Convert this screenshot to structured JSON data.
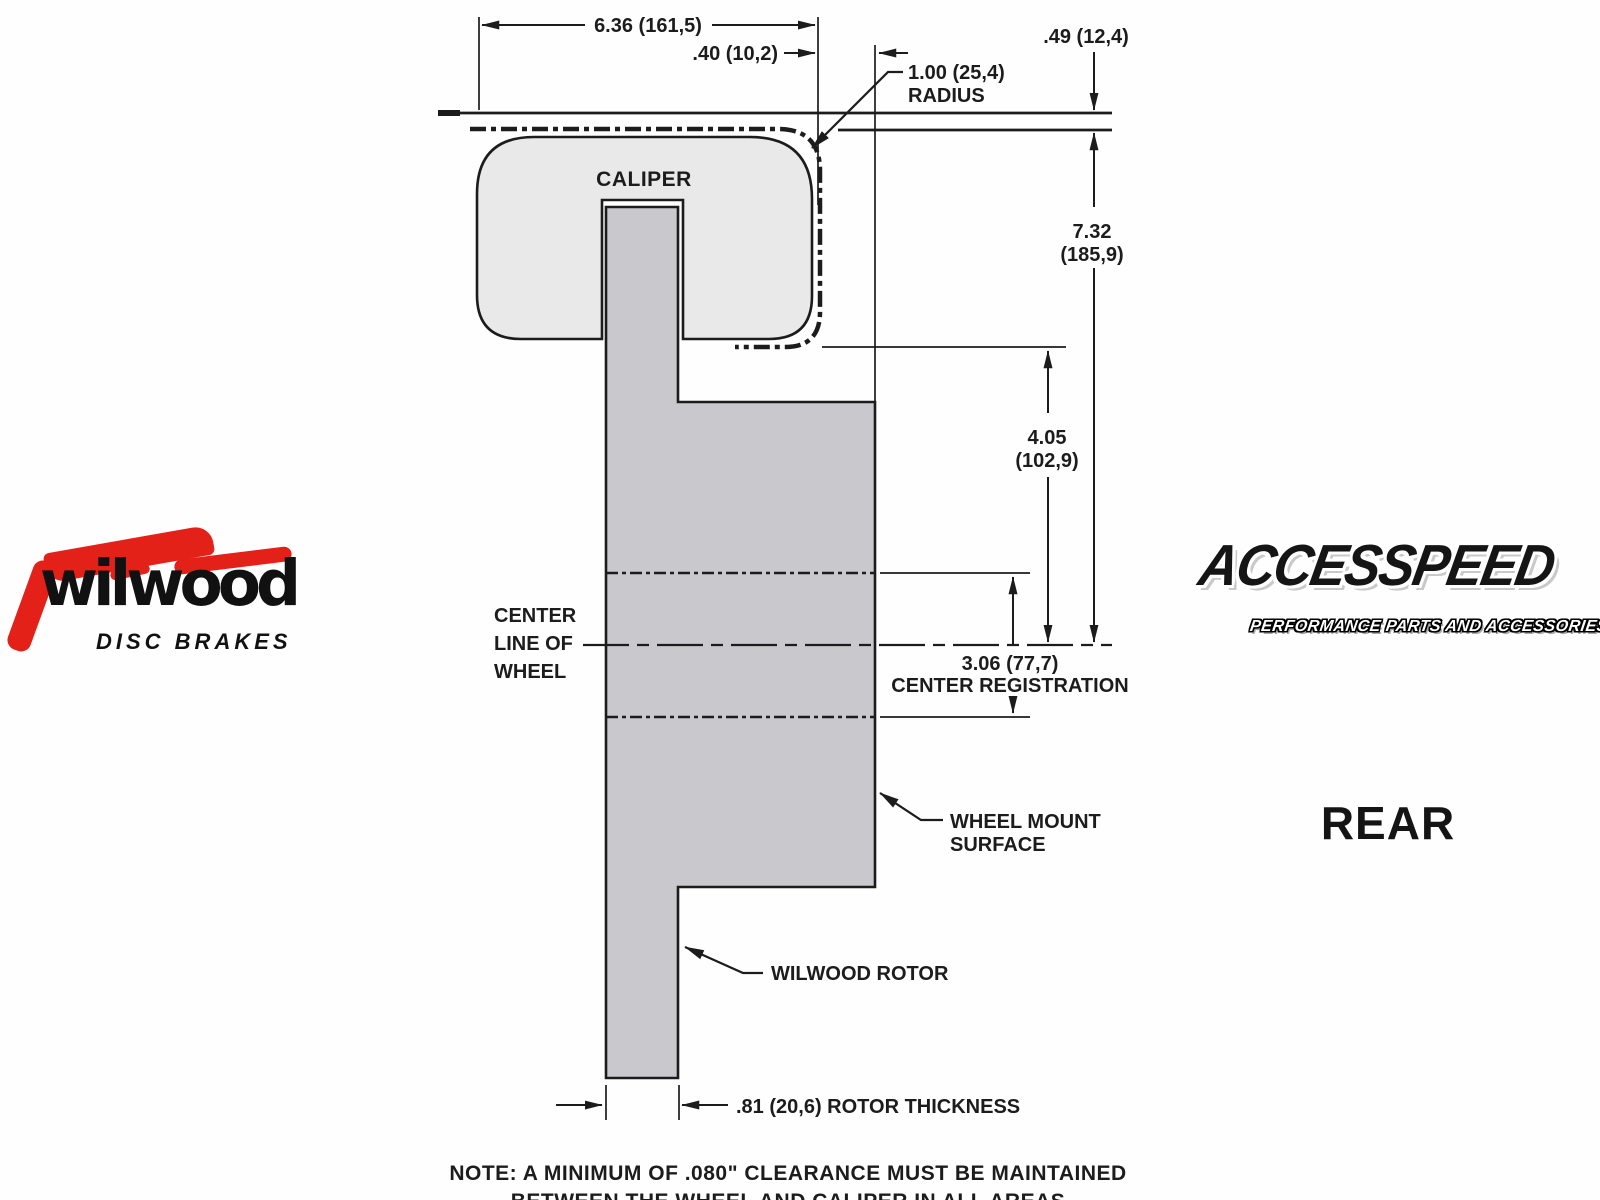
{
  "drawing": {
    "caliper_label": "CALIPER",
    "dim_caliper_width": "6.36 (161,5)",
    "dim_caliper_offset": ".40 (10,2)",
    "dim_wheel_gap": ".49 (12,4)",
    "radius_value": "1.00 (25,4)",
    "radius_word": "RADIUS",
    "dim_total_height_value": "7.32",
    "dim_total_height_mm": "(185,9)",
    "dim_mount_height_value": "4.05",
    "dim_mount_height_mm": "(102,9)",
    "centerline_word1": "CENTER",
    "centerline_word2": "LINE OF",
    "centerline_word3": "WHEEL",
    "center_registration_value": "3.06 (77,7)",
    "center_registration_label": "CENTER REGISTRATION",
    "wheel_mount_line1": "WHEEL MOUNT",
    "wheel_mount_line2": "SURFACE",
    "rotor_leader_label": "WILWOOD ROTOR",
    "rotor_thickness_label": ".81 (20,6) ROTOR THICKNESS",
    "note_line1": "NOTE: A MINIMUM OF .080\" CLEARANCE MUST BE MAINTAINED",
    "note_line2": "BETWEEN THE WHEEL AND CALIPER IN ALL AREAS"
  },
  "branding": {
    "wilwood_name": "wilwood",
    "wilwood_sub": "DISC BRAKES",
    "accesspeed_name": "ACCESSPEED",
    "accesspeed_sub": "PERFORMANCE PARTS AND ACCESSORIES",
    "position_label": "REAR"
  },
  "colors": {
    "line": "#1c1c1c",
    "caliper_fill": "#e9e9e9",
    "rotor_fill": "#c9c9cd",
    "wilwood_red": "#e32119",
    "logo_shadow": "#c9c9c9"
  }
}
